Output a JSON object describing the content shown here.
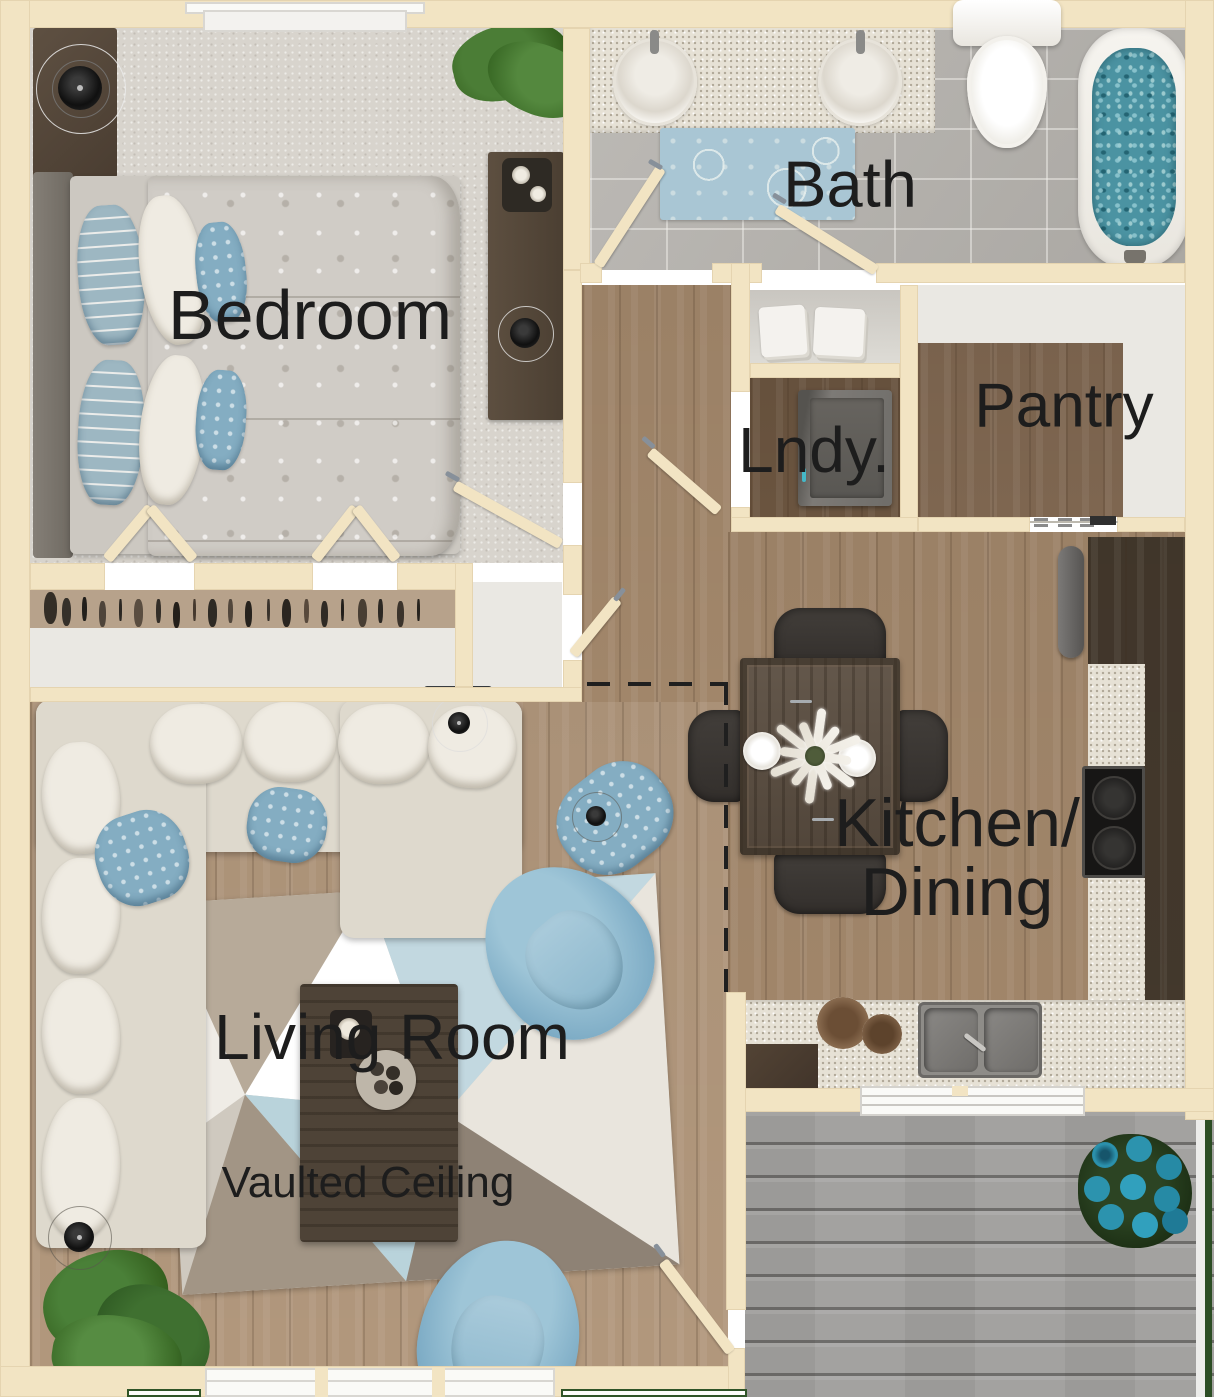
{
  "palette": {
    "wall": "#f2e4c3",
    "carpet": "#d8d4cd",
    "wood_hall": "#a1866a",
    "wood_living": "#b1977c",
    "wood_dark": "#6a543f",
    "deck_gray": "#a3a2a0",
    "accent_blue": "#8fbdd2",
    "label_text": "#1d1d1d"
  },
  "rooms": {
    "bedroom": {
      "label": "Bedroom"
    },
    "bath": {
      "label": "Bath"
    },
    "laundry": {
      "label": "Lndy."
    },
    "pantry": {
      "label": "Pantry"
    },
    "kitchen_dining": {
      "label_line1": "Kitchen/",
      "label_line2": "Dining"
    },
    "living_room": {
      "label": "Living Room",
      "note": "Vaulted Ceiling"
    }
  },
  "icons": {
    "ceiling_light": "concentric-circles",
    "plant": "green-foliage",
    "flower_pot": "blue-blossom-cluster"
  }
}
